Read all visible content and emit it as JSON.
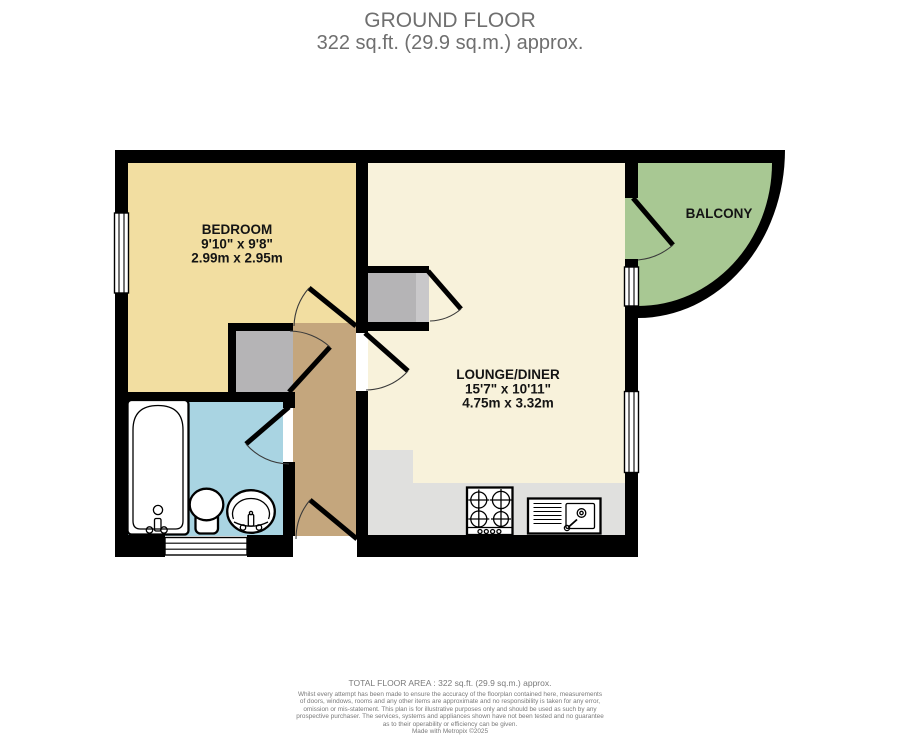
{
  "header": {
    "title": "GROUND FLOOR",
    "subtitle": "322 sq.ft. (29.9 sq.m.) approx."
  },
  "floorplan": {
    "bedroom": {
      "name": "BEDROOM",
      "imperial": "9'10\" x 9'8\"",
      "metric": "2.99m x 2.95m"
    },
    "lounge": {
      "name": "LOUNGE/DINER",
      "imperial": "15'7\" x 10'11\"",
      "metric": "4.75m x 3.32m"
    },
    "balcony": {
      "name": "BALCONY"
    }
  },
  "footer": {
    "total_area": "TOTAL FLOOR AREA : 322 sq.ft. (29.9 sq.m.) approx.",
    "disclaimer_lines": [
      "Whilst every attempt has been made to ensure the accuracy of the floorplan contained here, measurements",
      "of doors, windows, rooms and any other items are approximate and no responsibility is taken for any error,",
      "omission or mis-statement. This plan is for illustrative purposes only and should be used as such by any",
      "prospective purchaser. The services, systems and appliances shown have not been tested and no guarantee",
      "as to their operability or efficiency can be given."
    ],
    "credit": "Made with Metropix ©2025"
  },
  "colors": {
    "wall": "#000000",
    "bedroom_floor": "#F2DEA1",
    "lounge_floor": "#F8F2DB",
    "hall_floor": "#C4A67D",
    "bathroom_floor": "#A9D4E2",
    "balcony_floor": "#A8C893",
    "closet_floor": "#B5B4B6",
    "closet_shade": "#C9C8CA",
    "kitchen_floor": "#E0E0DE",
    "title_text": "#6F6F6F",
    "footer_text": "#7A7A7A",
    "label_text": "#141414"
  }
}
